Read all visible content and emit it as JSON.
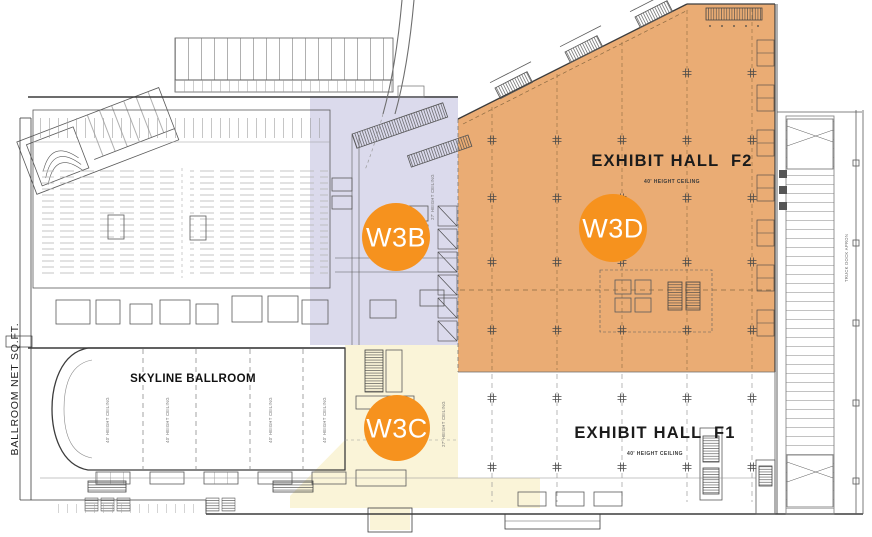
{
  "colors": {
    "zone_w3b": "#DBDAEC",
    "zone_w3c": "#FAF4D8",
    "zone_w3d": "#EAAC74",
    "badge": "#F6921E"
  },
  "zones": {
    "w3b": {
      "badge": "W3B",
      "ceiling_note": "27' HEIGHT CEILING"
    },
    "w3c": {
      "badge": "W3C",
      "ceiling_note": "27' HEIGHT CEILING"
    },
    "w3d": {
      "badge": "W3D"
    }
  },
  "halls": {
    "f2": {
      "name": "EXHIBIT HALL  F2",
      "ceiling": "40' HEIGHT CEILING"
    },
    "f1": {
      "name": "EXHIBIT HALL  F1",
      "ceiling": "40' HEIGHT CEILING"
    }
  },
  "ballroom": {
    "name": "SKYLINE BALLROOM",
    "side_label": "BALLROOM NET SQ.FT.",
    "section_ceiling": "40' HEIGHT CEILING"
  },
  "right_side": {
    "truck_dock_label": "TRUCK DOCK APRON"
  }
}
